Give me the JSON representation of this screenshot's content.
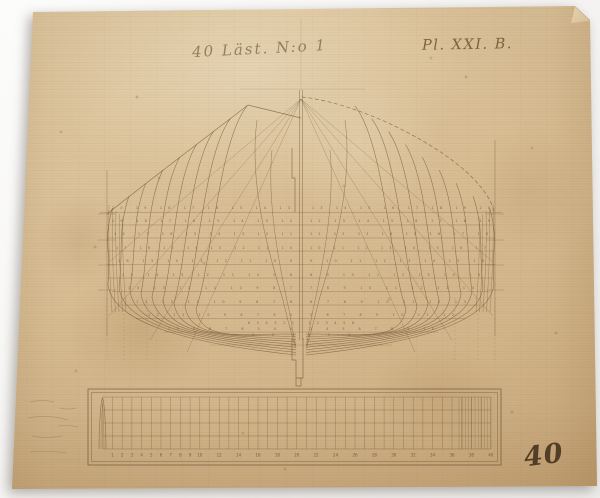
{
  "header": {
    "title_left": "40 Läst. N:o 1",
    "plate_label": "Pl. XXI. B."
  },
  "footer": {
    "sheet_number": "40"
  },
  "palette": {
    "paper": "#d8bd93",
    "ink": "#6d5535",
    "handwriting": "#7a603c"
  },
  "body_plan": {
    "number_rows": [
      {
        "y": 209,
        "x1": 112,
        "x2": 290,
        "text": "20 19 18 17 16 15 14 13"
      },
      {
        "y": 209,
        "x1": 312,
        "x2": 490,
        "text": "13 14 15 16 17 18 19 20"
      },
      {
        "y": 222,
        "x1": 112,
        "x2": 292,
        "text": "19 18 17 16 15 14 13 12"
      },
      {
        "y": 222,
        "x1": 310,
        "x2": 490,
        "text": "12 13 14 15 16 17 18 19"
      },
      {
        "y": 235,
        "x1": 114,
        "x2": 292,
        "text": "18 17 16 15 14 13 12 11"
      },
      {
        "y": 235,
        "x1": 310,
        "x2": 488,
        "text": "11 12 13 14 15 16 17 18"
      },
      {
        "y": 249,
        "x1": 116,
        "x2": 292,
        "text": "17 16 15 14 13 12 11 10"
      },
      {
        "y": 249,
        "x1": 310,
        "x2": 486,
        "text": "10 11 12 13 14 15 16 17"
      },
      {
        "y": 262,
        "x1": 118,
        "x2": 292,
        "text": "16 15 14 13 12 11 10 9"
      },
      {
        "y": 262,
        "x1": 310,
        "x2": 484,
        "text": "9 10 11 12 13 14 15 16"
      },
      {
        "y": 276,
        "x1": 122,
        "x2": 292,
        "text": "15 14 13 12 11 10 9 8"
      },
      {
        "y": 276,
        "x1": 310,
        "x2": 480,
        "text": "8 9 10 11 12 13 14 15"
      },
      {
        "y": 289,
        "x1": 128,
        "x2": 292,
        "text": "14 13 12 11 10 9 8 7"
      },
      {
        "y": 289,
        "x1": 310,
        "x2": 474,
        "text": "7 8 9 10 11 12 13 14"
      },
      {
        "y": 303,
        "x1": 136,
        "x2": 292,
        "text": "13 12 11 10 9 8 7 6"
      },
      {
        "y": 303,
        "x1": 310,
        "x2": 466,
        "text": "6 7 8 9 10 11 12 13"
      },
      {
        "y": 316,
        "x1": 148,
        "x2": 292,
        "text": "12 11 10 9 8 7 6 5"
      },
      {
        "y": 316,
        "x1": 310,
        "x2": 454,
        "text": "5 6 7 8 9 10 11 12"
      },
      {
        "y": 330,
        "x1": 168,
        "x2": 292,
        "text": "10 9 8 7 6 5 4 3"
      },
      {
        "y": 330,
        "x1": 310,
        "x2": 434,
        "text": "3 4 5 6 7 8 9 10"
      },
      {
        "y": 324,
        "x1": 248,
        "x2": 294,
        "text": "6 5 4 3 2 1"
      },
      {
        "y": 324,
        "x1": 308,
        "x2": 354,
        "text": "1 2 3 4 5 6"
      },
      {
        "y": 336,
        "x1": 252,
        "x2": 294,
        "text": "3 2 1"
      },
      {
        "y": 336,
        "x1": 308,
        "x2": 350,
        "text": "1 2 3"
      }
    ]
  },
  "scale_bar": {
    "stations": [
      1,
      2,
      3,
      4,
      5,
      6,
      7,
      8,
      9,
      10,
      12,
      14,
      16,
      18,
      20,
      22,
      24,
      26,
      28,
      30,
      32,
      34,
      36,
      38,
      40
    ]
  }
}
